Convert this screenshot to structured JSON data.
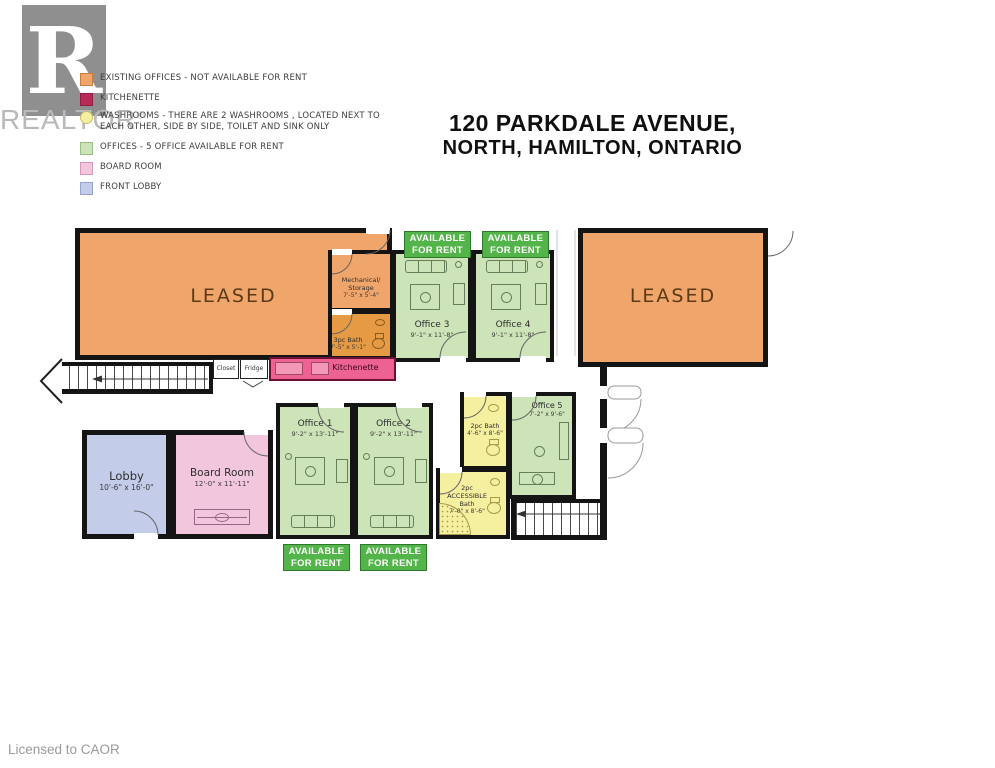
{
  "title": {
    "line1": "120 PARKDALE AVENUE,",
    "line2": "NORTH, HAMILTON, ONTARIO"
  },
  "watermark": {
    "logo_letter": "R",
    "brand": "REALTOR",
    "registered": "®"
  },
  "legend": {
    "items": [
      {
        "label": "EXISTING OFFICES - NOT AVAILABLE FOR RENT",
        "color": "#F0A56B"
      },
      {
        "label": "KITCHENETTE",
        "color": "#B72B57"
      },
      {
        "label": "WASHROOMS - THERE ARE 2 WASHROOMS , LOCATED NEXT TO EACH OTHER, SIDE BY SIDE, TOILET AND SINK ONLY",
        "color": "#F5EFA0"
      },
      {
        "label": "OFFICES - 5 OFFICE AVAILABLE FOR RENT",
        "color": "#CDE3B8"
      },
      {
        "label": "BOARD ROOM",
        "color": "#F2C7DD"
      },
      {
        "label": "FRONT LOBBY",
        "color": "#C3CCE8"
      }
    ]
  },
  "badge": {
    "line1": "AVAILABLE",
    "line2": "FOR RENT"
  },
  "rooms": {
    "leased_left": {
      "label": "LEASED"
    },
    "leased_right": {
      "label": "LEASED"
    },
    "mechanical": {
      "label": "Mechanical/ Storage",
      "dims": "7'-5\" x 5'-4\""
    },
    "bath_3pc": {
      "label": "3pc Bath",
      "dims": "7'-5\" x 5'-1\""
    },
    "office_1": {
      "label": "Office 1",
      "dims": "9'-2\" x 13'-11\""
    },
    "office_2": {
      "label": "Office 2",
      "dims": "9'-2\" x 13'-11\""
    },
    "office_3": {
      "label": "Office 3",
      "dims": "9'-1\" x 11'-8\""
    },
    "office_4": {
      "label": "Office 4",
      "dims": "9'-1\" x 11'-8\""
    },
    "office_5": {
      "label": "Office 5",
      "dims": "7'-2\" x 9'-6\""
    },
    "bath_2pc": {
      "label": "2pc Bath",
      "dims": "4'-6\" x 8'-6\""
    },
    "bath_accessible": {
      "label": "2pc ACCESSIBLE Bath",
      "dims": "7'-0\" x 8'-6\""
    },
    "lobby": {
      "label": "Lobby",
      "dims": "10'-6\" x 16'-0\""
    },
    "board_room": {
      "label": "Board Room",
      "dims": "12'-0\" x 11'-11\""
    },
    "kitchenette": {
      "label": "Kitchenette"
    },
    "closet": {
      "label": "Closet"
    },
    "fridge": {
      "label": "Fridge"
    }
  },
  "colors": {
    "walls": "#141414",
    "existing_offices": "#F0A56B",
    "offices_available": "#CDE3B8",
    "washrooms": "#F5EFA0",
    "board_room": "#F2C7DD",
    "front_lobby": "#C3CCE8",
    "kitchenette": "#EE6293",
    "available_badge": "#53B44A",
    "bath_3pc": "#E59A43"
  },
  "footer": {
    "license": "Licensed to CAOR"
  }
}
